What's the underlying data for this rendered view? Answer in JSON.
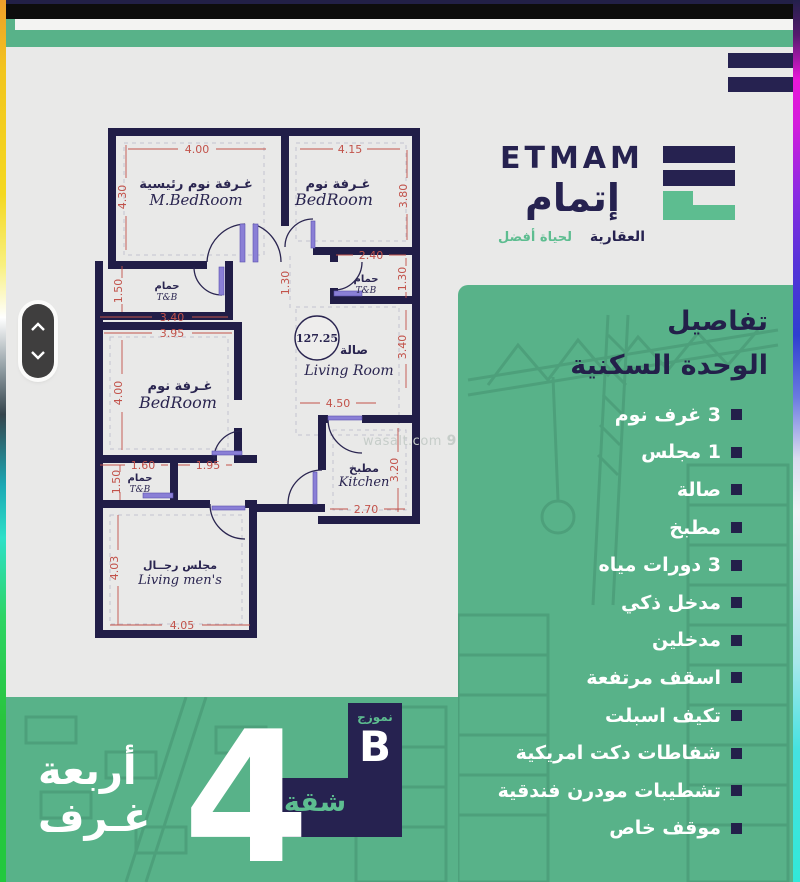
{
  "brand": {
    "wordmark": "ETMAM",
    "arabic_name": "إتمام",
    "tagline_right": "العقارية",
    "tagline_left": "لحياة أفضل"
  },
  "watermark": {
    "text": "wasalt.com",
    "logo_digit": "9"
  },
  "panel": {
    "title_line1": "تفاصيل",
    "title_line2": "الوحدة السكنية",
    "items": [
      "3 غرف نوم",
      "1 مجلس",
      "صالة",
      "مطبخ",
      "3 دورات مياه",
      "مدخل ذكي",
      "مدخلين",
      "اسقف مرتفعة",
      "تكيف اسبلت",
      "شفاطات دكت امريكية",
      "تشطيبات مودرن فندقية",
      "موقف خاص"
    ]
  },
  "badge": {
    "model_label": "نموزج",
    "model_letter": "B",
    "unit_type": "شقة",
    "big_number": "4",
    "rooms_line1": "أربعة",
    "rooms_line2": "غـرف"
  },
  "floorplan": {
    "area": "127.25",
    "rooms": {
      "mbed": {
        "ar": "غـرفة نوم رئيسية",
        "en": "M.BedRoom",
        "w": "4.00",
        "h": "4.30"
      },
      "bed2": {
        "ar": "غـرفة نوم",
        "en": "BedRoom",
        "w": "4.15",
        "h": "3.80"
      },
      "bath1": {
        "ar": "حمام",
        "en": "T&B",
        "h": "1.50",
        "w": "3.40"
      },
      "bath2": {
        "ar": "حمام",
        "en": "T&B",
        "w": "2.40",
        "h": "1.30"
      },
      "hall": {
        "w": "1.30"
      },
      "living": {
        "ar": "صالة",
        "en": "Living Room",
        "h": "3.40",
        "w": "4.50"
      },
      "bed3": {
        "ar": "غـرفة نوم",
        "en": "BedRoom",
        "w": "3.95",
        "h": "4.00"
      },
      "bath3": {
        "ar": "حمام",
        "en": "T&B",
        "w": "1.60",
        "h": "1.50"
      },
      "lobby": {
        "w": "1.95"
      },
      "kitchen": {
        "ar": "مطبخ",
        "en": "Kitchen",
        "h": "3.20",
        "w": "2.70"
      },
      "majlis": {
        "ar": "مجلس رجــال",
        "en": "Living men's",
        "h": "4.03",
        "w": "4.05"
      }
    }
  },
  "colors": {
    "green": "#58b289",
    "navy": "#23204a",
    "plan_wall": "#211d47",
    "dim_red": "#c2524a",
    "teal_text": "#5dbd90",
    "door_leaf": "#8a7fd6"
  }
}
